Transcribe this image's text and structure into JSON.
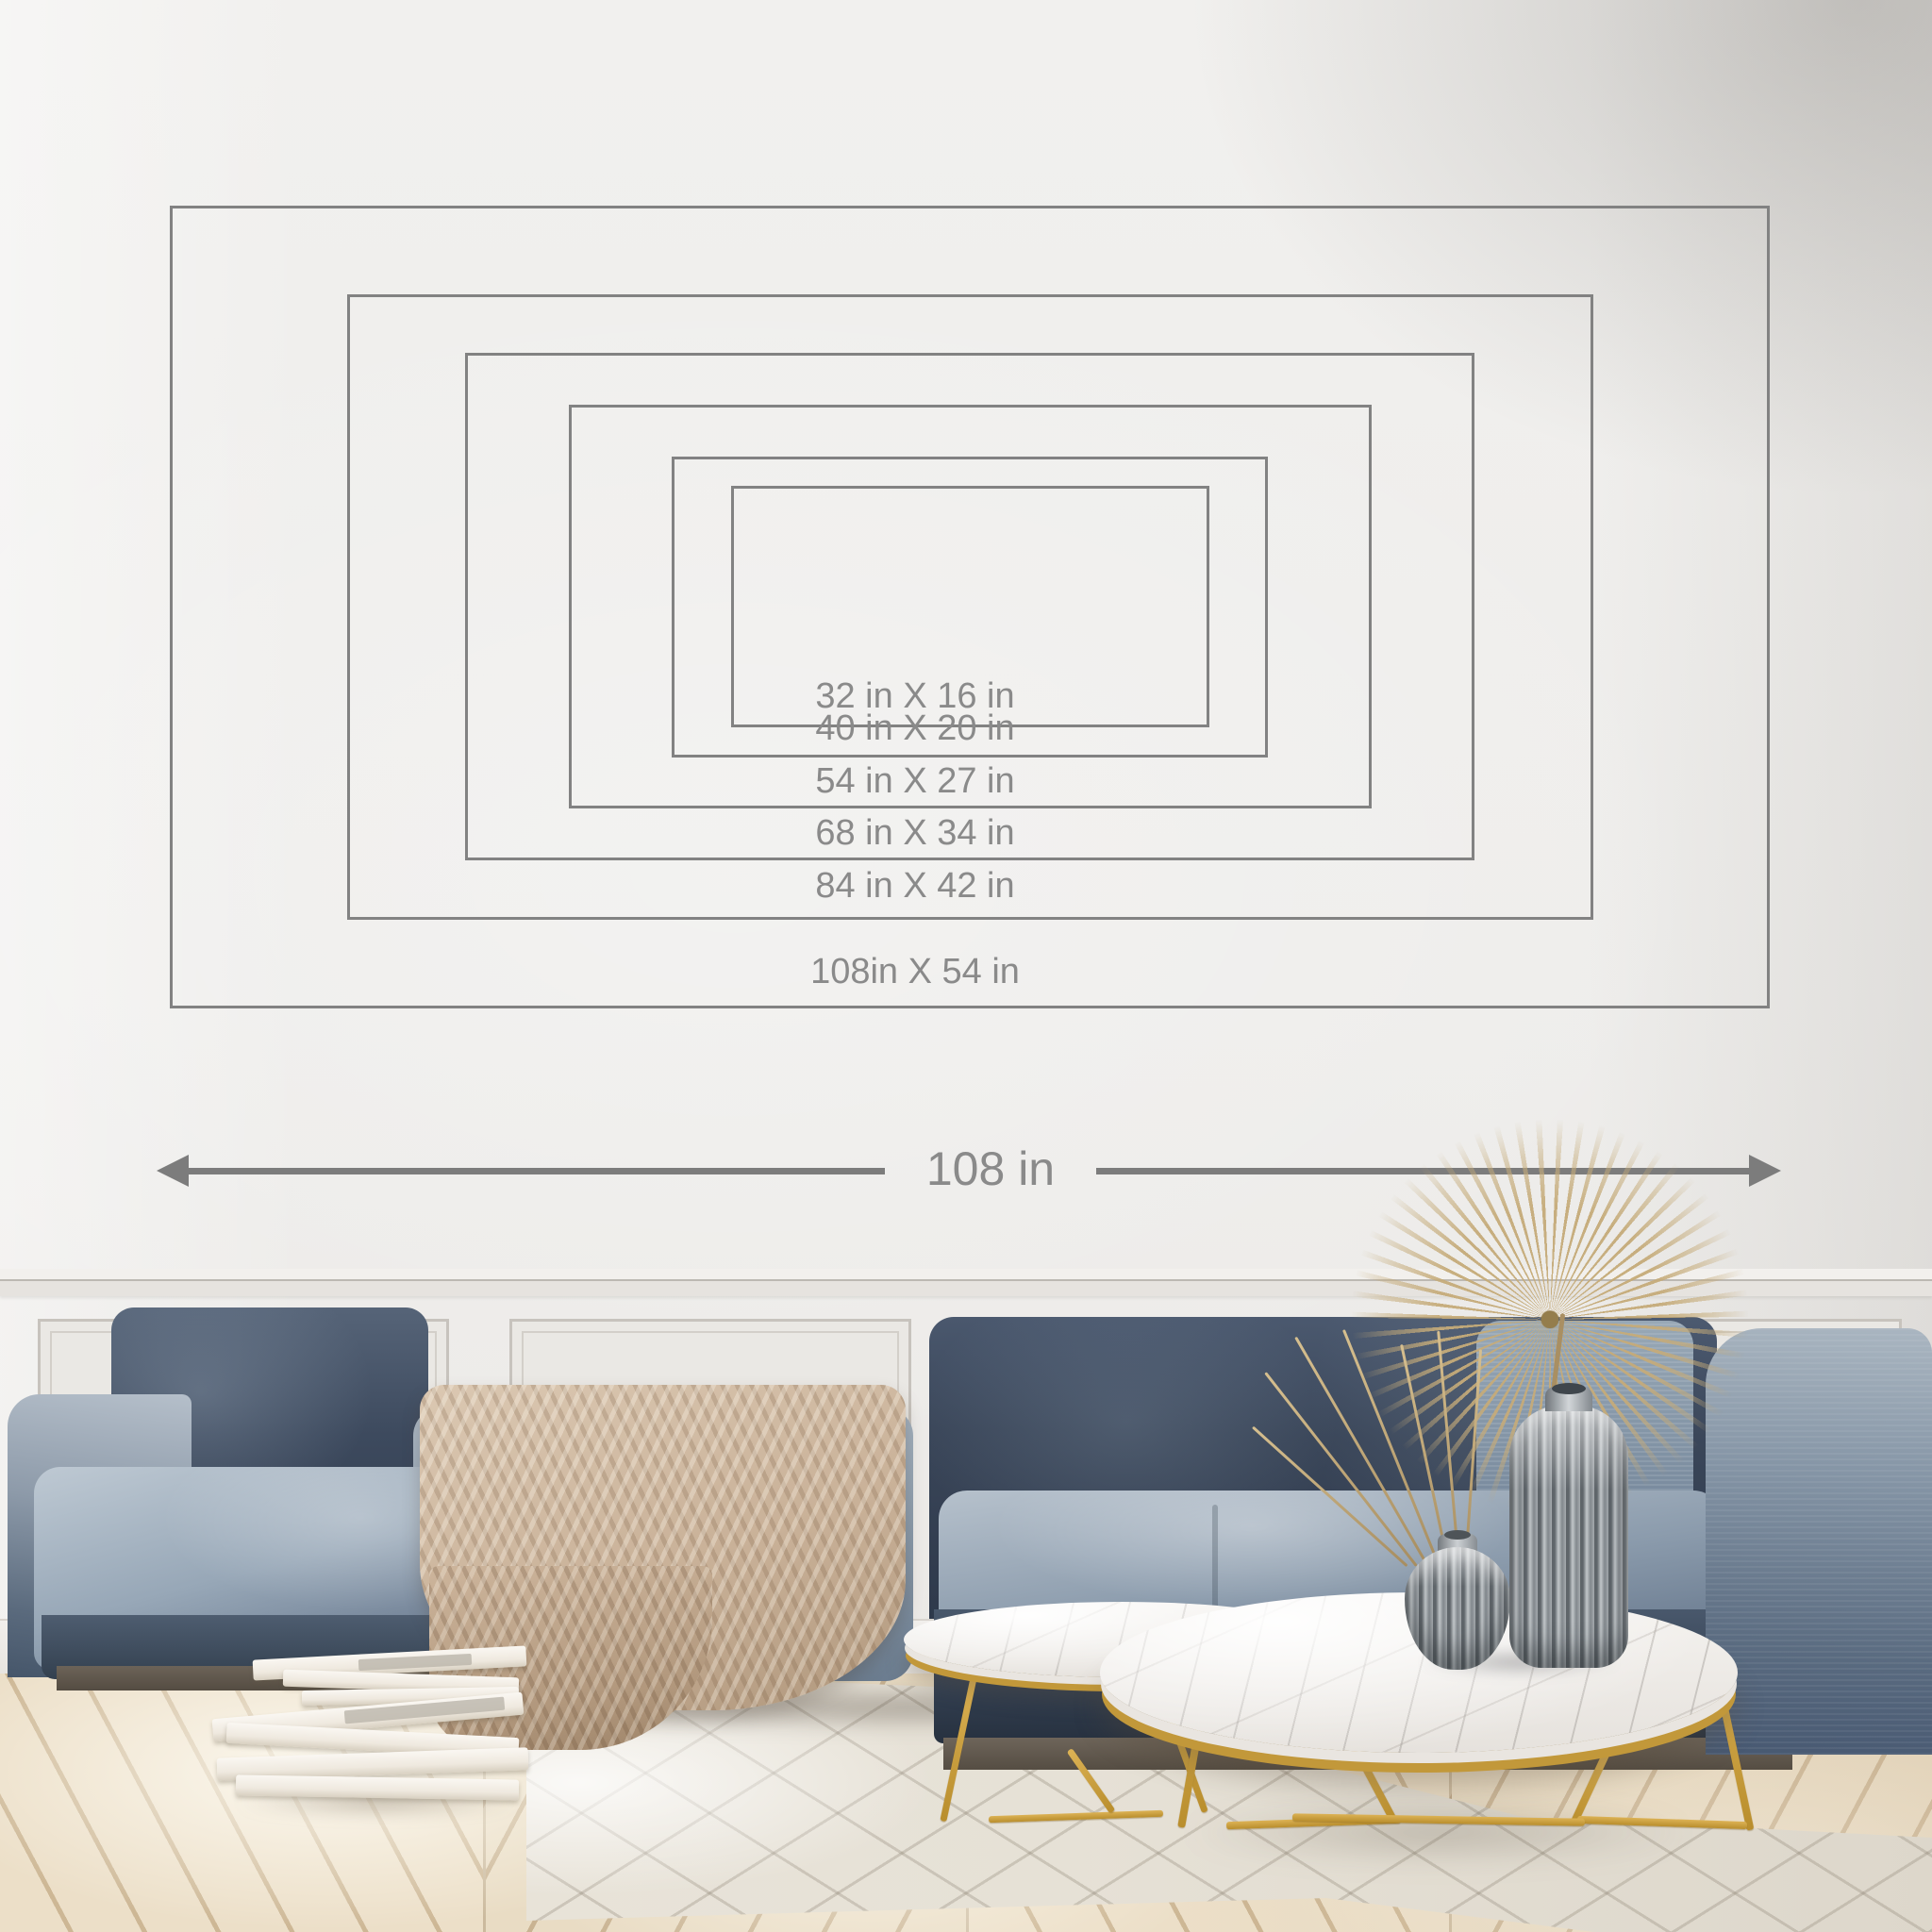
{
  "size_guide": {
    "sizes": [
      {
        "label": "32 in X 16 in",
        "width_in": 32,
        "height_in": 16
      },
      {
        "label": "40 in X 20 in",
        "width_in": 40,
        "height_in": 20
      },
      {
        "label": "54 in X 27 in",
        "width_in": 54,
        "height_in": 27
      },
      {
        "label": "68 in X 34 in",
        "width_in": 68,
        "height_in": 34
      },
      {
        "label": "84 in X 42 in",
        "width_in": 84,
        "height_in": 42
      },
      {
        "label": "108in X 54 in",
        "width_in": 108,
        "height_in": 54
      }
    ],
    "width_arrow": {
      "label": "108 in",
      "width_in": 108
    },
    "line_color": "#828282",
    "text_color": "#8a8a8a"
  },
  "scene": {
    "description": "Living room photo used as wall-mural size guide: navy velvet modular sofa with beige knit throw, round white marble nesting coffee tables with gold wire legs, ribbed smoke-glass vases holding dried fan palm and grasses, stacks of white books on a whitewashed chevron parquet floor, panelled wainscot wall",
    "colors": {
      "wall": "#eeedeb",
      "sofa_dark": "#39455a",
      "sofa_light": "#93a3b3",
      "blanket": "#c7b098",
      "floor_wood": "#e9dec9",
      "rug": "#e7e2d8",
      "gold": "#c49a35",
      "marble": "#f1efec",
      "palm": "#c2a778"
    }
  }
}
